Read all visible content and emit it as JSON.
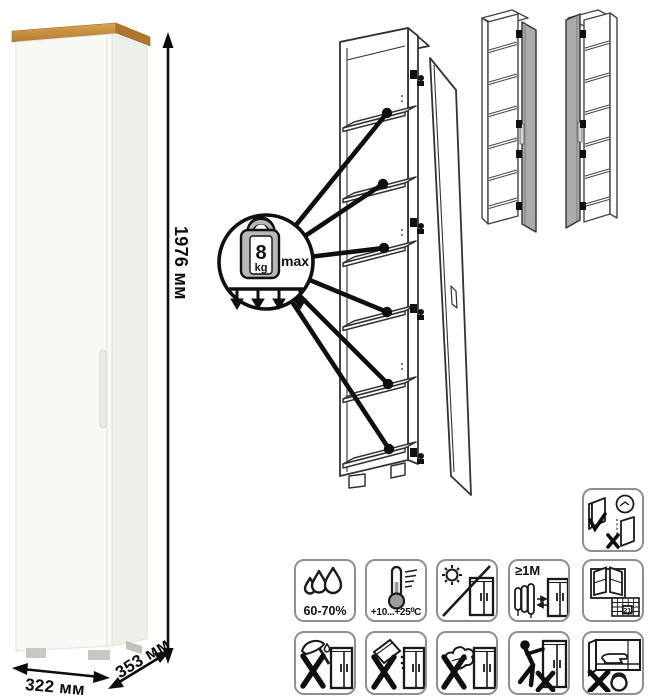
{
  "photo": {
    "height_label": "1976 мм",
    "width_label": "322 мм",
    "depth_label": "353 мм",
    "wood_color": "#c9913f",
    "body_color": "#f7f7f4"
  },
  "load_badge": {
    "value": "8",
    "unit": "kg",
    "qualifier": "max",
    "shelf_pointer_count": 6
  },
  "variants": {
    "left_hinged": "door-right-variant",
    "right_hinged": "door-left-variant"
  },
  "care": {
    "humidity": "60-70%",
    "temperature": "+10...+25⁰C",
    "distance": "≥1M",
    "ventilation_day": "21"
  },
  "icons": [
    "door-adjustment-icon",
    "humidity-icon",
    "temperature-icon",
    "no-sunlight-icon",
    "heat-distance-icon",
    "ventilation-calendar-icon",
    "no-sharp-tools-icon",
    "no-abrasive-powder-icon",
    "no-abrasive-sponge-icon",
    "no-dragging-icon",
    "no-overload-icon"
  ]
}
